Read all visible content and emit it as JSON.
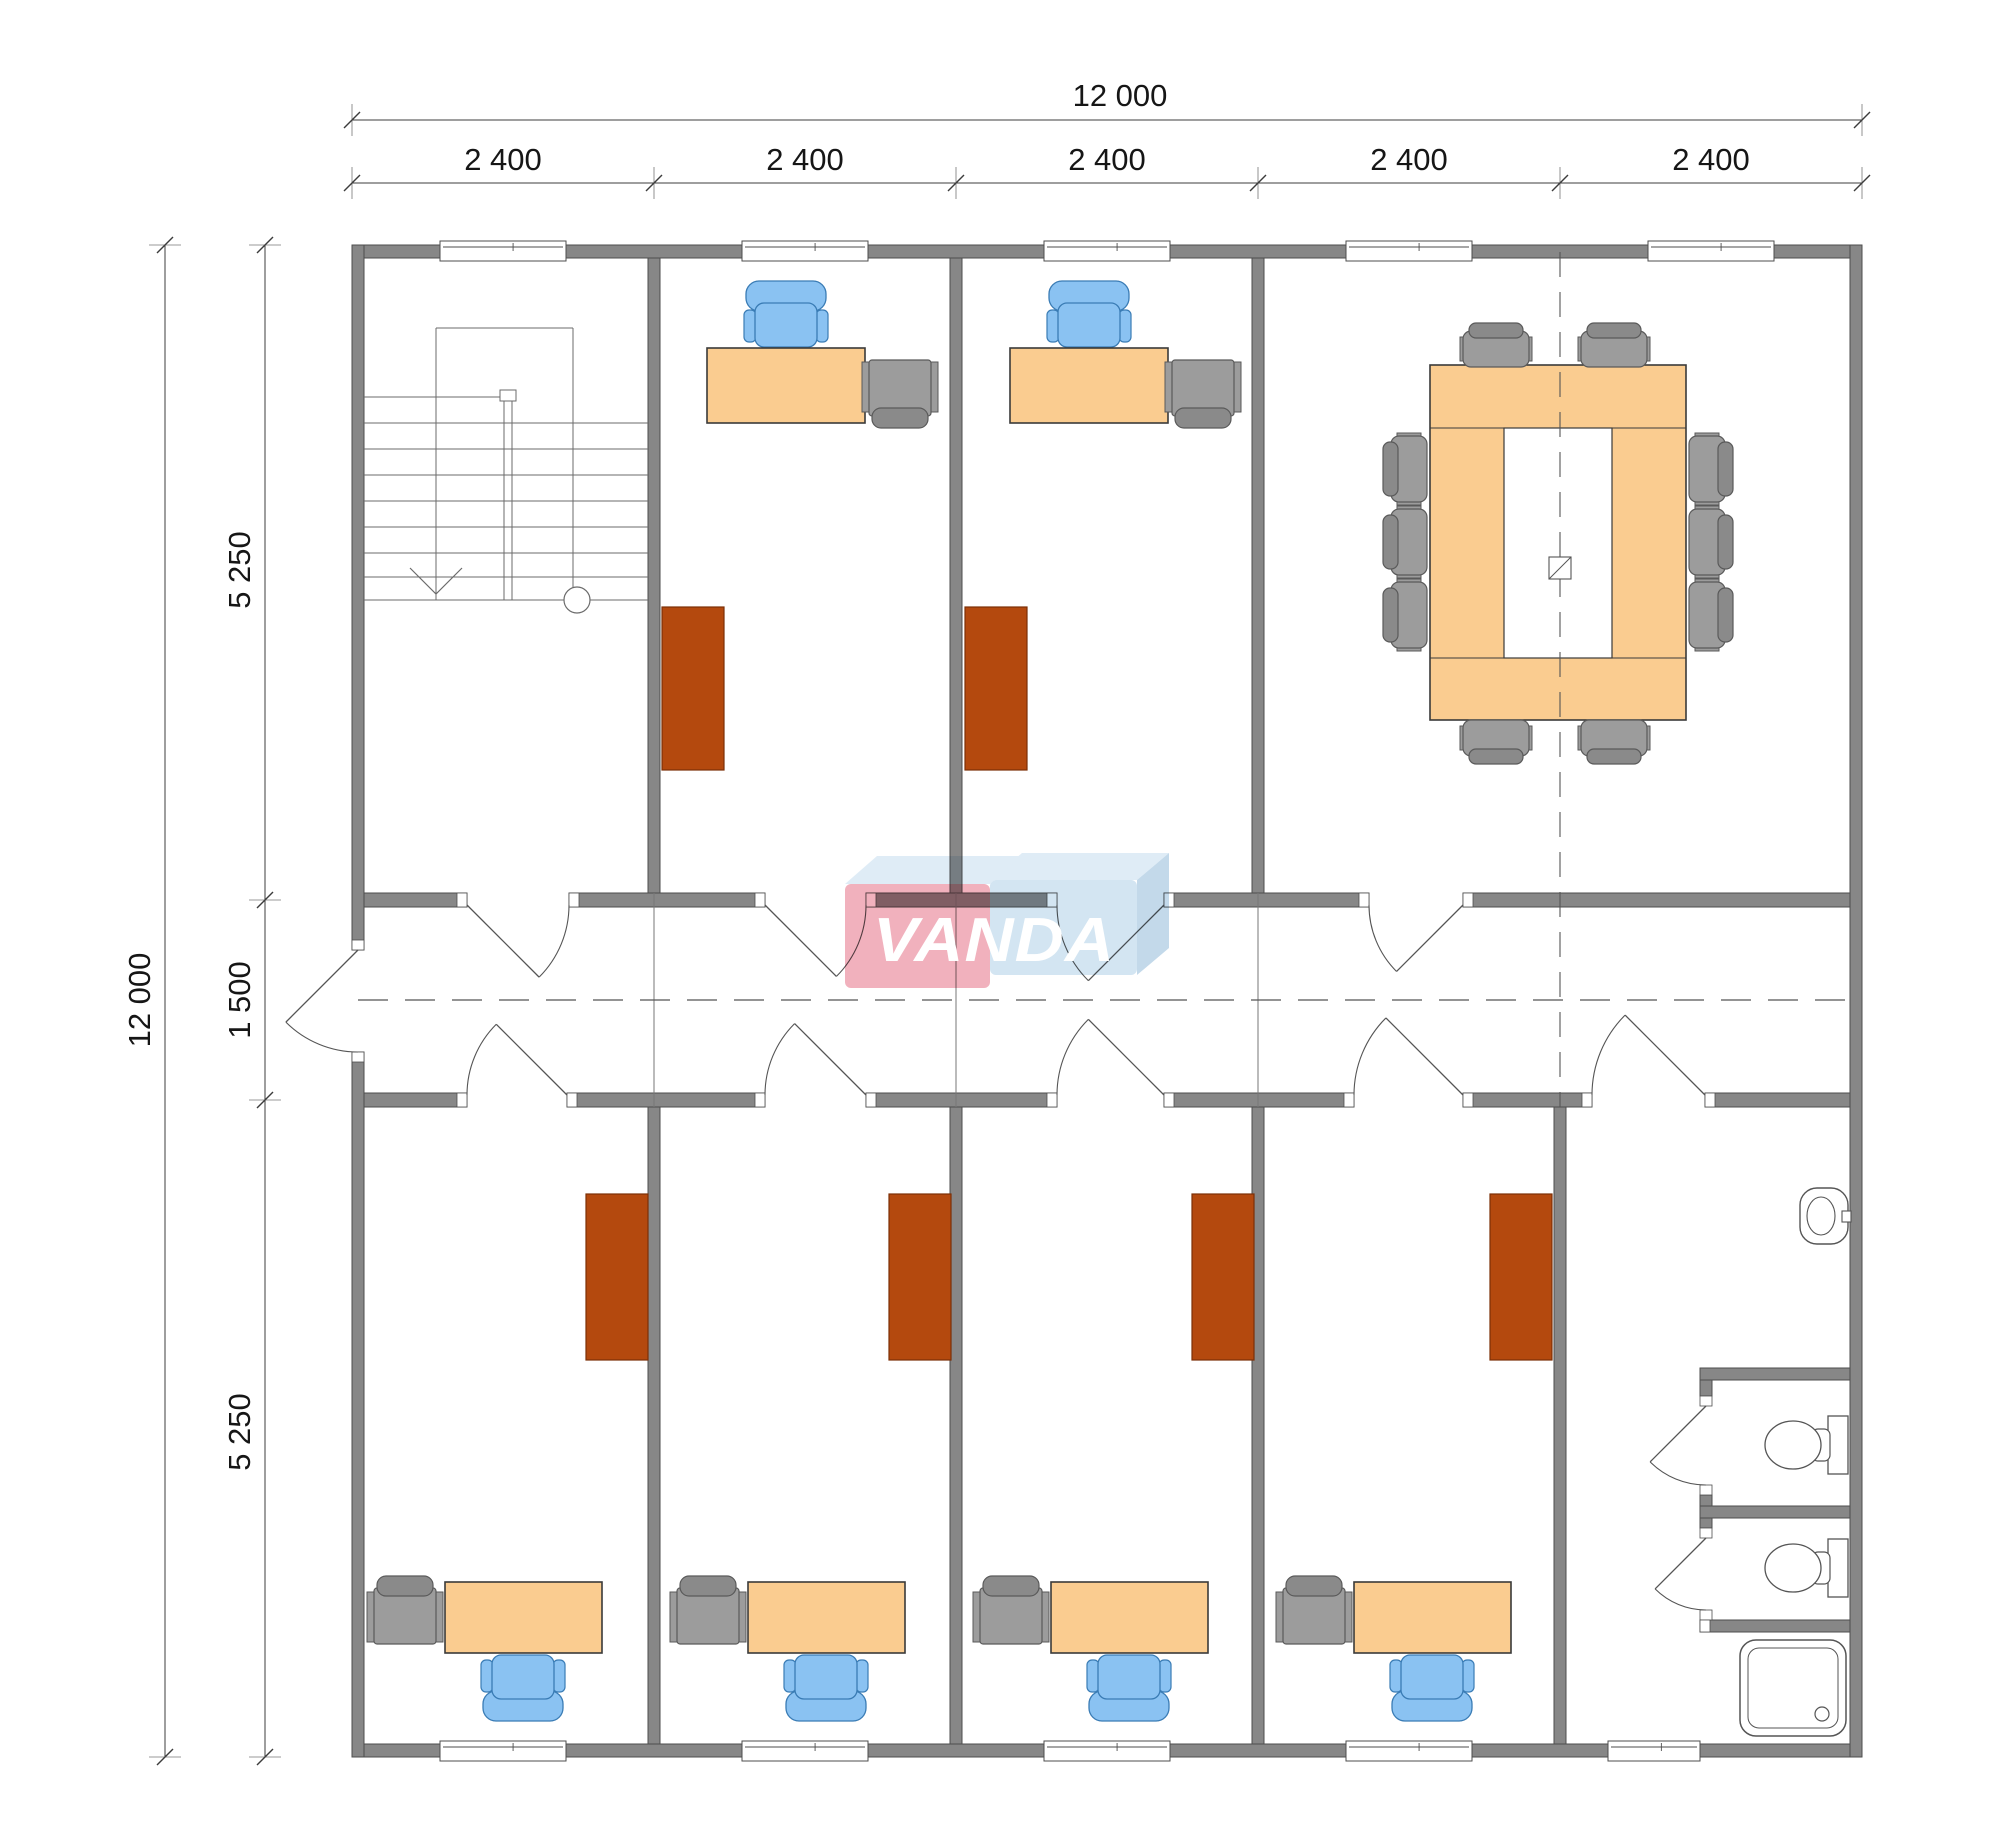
{
  "canvas": {
    "w": 2000,
    "h": 1848,
    "bg": "#ffffff"
  },
  "palette": {
    "wall": "#878787",
    "wall_stroke": "#4e4e4e",
    "cap": "#ffffff",
    "line": "#555555",
    "thin": "#777777",
    "dim": "#3c3c3c",
    "desk": "#FACC90",
    "desk_stroke": "#3a3a3a",
    "blue": "#8AC2F2",
    "blue_stroke": "#3a7cb5",
    "gray_f": "#9C9C9C",
    "gray_dark": "#8A8A8A",
    "gray_stroke": "#5a5a5a",
    "brown": "#B4490E",
    "brown_stroke": "#7c2f06",
    "logo_pink": "#F0A9B6",
    "logo_blue": "#CEE2F1",
    "logo_top": "#DCEAF5",
    "logo_side": "#BDD5E8"
  },
  "watermark": {
    "text": "VANDA"
  },
  "dimensions": {
    "top_total": {
      "label": "12 000",
      "y": 120,
      "x1": 352,
      "x2": 1862,
      "lx": 1120,
      "ly": 106
    },
    "top_bays": {
      "y": 183,
      "ticks": [
        352,
        654,
        956,
        1258,
        1560,
        1862
      ],
      "label_y": 170,
      "labels": [
        {
          "text": "2 400",
          "x": 503
        },
        {
          "text": "2 400",
          "x": 805
        },
        {
          "text": "2 400",
          "x": 1107
        },
        {
          "text": "2 400",
          "x": 1409
        },
        {
          "text": "2 400",
          "x": 1711
        }
      ]
    },
    "left_total": {
      "label": "12 000",
      "x": 165,
      "y1": 245,
      "y2": 1757,
      "lx": 150,
      "ly": 1000
    },
    "left_segs": {
      "x": 265,
      "ticks": [
        245,
        900,
        1100,
        1757
      ],
      "label_x": 250,
      "labels": [
        {
          "text": "5 250",
          "y": 570
        },
        {
          "text": "1 500",
          "y": 1000
        },
        {
          "text": "5 250",
          "y": 1432
        }
      ]
    }
  },
  "plan": {
    "outer_walls": [
      [
        352,
        245,
        1510,
        13
      ],
      [
        352,
        1744,
        1510,
        13
      ],
      [
        352,
        245,
        12,
        705
      ],
      [
        352,
        1052,
        12,
        705
      ],
      [
        1850,
        245,
        12,
        1512
      ]
    ],
    "inner_walls": [
      [
        648,
        258,
        12,
        635
      ],
      [
        950,
        258,
        12,
        635
      ],
      [
        1252,
        258,
        12,
        635
      ],
      [
        648,
        1107,
        12,
        637
      ],
      [
        950,
        1107,
        12,
        637
      ],
      [
        1252,
        1107,
        12,
        637
      ],
      [
        1554,
        1107,
        12,
        637
      ]
    ],
    "hwall_top": {
      "y": 893,
      "h": 14,
      "segs": [
        [
          364,
          467
        ],
        [
          569,
          765
        ],
        [
          866,
          1057
        ],
        [
          1164,
          1369
        ],
        [
          1463,
          1850
        ]
      ]
    },
    "hwall_bot": {
      "y": 1093,
      "h": 14,
      "segs": [
        [
          364,
          467
        ],
        [
          567,
          765
        ],
        [
          866,
          1057
        ],
        [
          1164,
          1354
        ],
        [
          1463,
          1592
        ],
        [
          1705,
          1850
        ]
      ]
    },
    "gaps_top": [
      [
        467,
        569
      ],
      [
        765,
        866
      ],
      [
        1057,
        1164
      ],
      [
        1369,
        1463
      ]
    ],
    "gaps_bot": [
      [
        467,
        567
      ],
      [
        765,
        866
      ],
      [
        1057,
        1164
      ],
      [
        1354,
        1463
      ],
      [
        1592,
        1705
      ]
    ],
    "entrance_caps": [
      [
        352,
        940,
        12,
        10
      ],
      [
        352,
        1052,
        12,
        10
      ]
    ],
    "windows_top": {
      "y": 241,
      "h": 20,
      "items": [
        [
          440,
          126
        ],
        [
          742,
          126
        ],
        [
          1044,
          126
        ],
        [
          1346,
          126
        ],
        [
          1648,
          126
        ]
      ]
    },
    "windows_bot": {
      "y": 1741,
      "h": 20,
      "items": [
        [
          440,
          126
        ],
        [
          742,
          126
        ],
        [
          1044,
          126
        ],
        [
          1346,
          126
        ],
        [
          1608,
          92
        ]
      ]
    },
    "centerlines": {
      "solid_x": [
        654,
        956,
        1258
      ],
      "cl_y1": 893,
      "cl_y2": 1107,
      "dash_x": 1560,
      "dash_y1": 252,
      "dash_y2": 1107,
      "corridor_y": 1000,
      "corridor_x1": 358,
      "corridor_x2": 1850
    },
    "doors": [
      {
        "h": [
          467,
          905
        ],
        "j": [
          569,
          905
        ],
        "r": 1
      },
      {
        "h": [
          765,
          905
        ],
        "j": [
          866,
          905
        ],
        "r": 1
      },
      {
        "h": [
          1164,
          905
        ],
        "j": [
          1057,
          905
        ],
        "r": -1
      },
      {
        "h": [
          1463,
          905
        ],
        "j": [
          1369,
          905
        ],
        "r": -1
      },
      {
        "h": [
          567,
          1095
        ],
        "j": [
          467,
          1095
        ],
        "r": 1
      },
      {
        "h": [
          866,
          1095
        ],
        "j": [
          765,
          1095
        ],
        "r": 1
      },
      {
        "h": [
          1164,
          1095
        ],
        "j": [
          1057,
          1095
        ],
        "r": 1
      },
      {
        "h": [
          1463,
          1095
        ],
        "j": [
          1354,
          1095
        ],
        "r": 1
      },
      {
        "h": [
          1705,
          1095
        ],
        "j": [
          1592,
          1095
        ],
        "r": 1
      },
      {
        "h": [
          358,
          950
        ],
        "j": [
          358,
          1052
        ],
        "r": 1
      }
    ],
    "stairs": {
      "x1": 364,
      "x2": 648,
      "outline": {
        "vx1": 436,
        "vx2": 573,
        "top": 328,
        "bot": 600
      },
      "treads_full": [
        423,
        449,
        475,
        501,
        527,
        553,
        577
      ],
      "tread_partial": 397,
      "bottom": 600,
      "rail_x": [
        504,
        512
      ],
      "rail_y1": 398,
      "rail_y2": 600,
      "rail_cap": [
        500,
        390,
        16,
        11
      ],
      "arrow": [
        [
          410,
          568
        ],
        [
          436,
          594
        ],
        [
          462,
          568
        ]
      ],
      "circle": [
        577,
        600,
        13
      ]
    },
    "offices_top": [
      {
        "desk": [
          707,
          348,
          158,
          75
        ],
        "chair_cx": 786,
        "chair_cy": 318,
        "side": [
          900,
          388
        ],
        "cab": [
          662,
          607,
          62,
          163
        ]
      },
      {
        "desk": [
          1010,
          348,
          158,
          75
        ],
        "chair_cx": 1089,
        "chair_cy": 318,
        "side": [
          1203,
          388
        ],
        "cab": [
          965,
          607,
          62,
          163
        ]
      }
    ],
    "offices_bot": [
      {
        "desk": [
          445,
          1582,
          157,
          71
        ],
        "chair_cx": 523,
        "chair_cy": 1684,
        "side": [
          405,
          1616
        ],
        "cab": [
          586,
          1194,
          62,
          166
        ]
      },
      {
        "desk": [
          748,
          1582,
          157,
          71
        ],
        "chair_cx": 826,
        "chair_cy": 1684,
        "side": [
          708,
          1616
        ],
        "cab": [
          889,
          1194,
          62,
          166
        ]
      },
      {
        "desk": [
          1051,
          1582,
          157,
          71
        ],
        "chair_cx": 1129,
        "chair_cy": 1684,
        "side": [
          1011,
          1616
        ],
        "cab": [
          1192,
          1194,
          62,
          166
        ]
      },
      {
        "desk": [
          1354,
          1582,
          157,
          71
        ],
        "chair_cx": 1432,
        "chair_cy": 1684,
        "side": [
          1314,
          1616
        ],
        "cab": [
          1490,
          1194,
          62,
          166
        ]
      }
    ],
    "meeting": {
      "table": [
        1430,
        365,
        256,
        355
      ],
      "inner": [
        1504,
        428,
        108,
        230
      ],
      "square": [
        1549,
        557,
        22
      ],
      "chairs": [
        {
          "x": 1496,
          "y": 348,
          "d": 0
        },
        {
          "x": 1614,
          "y": 348,
          "d": 0
        },
        {
          "x": 1496,
          "y": 739,
          "d": 180
        },
        {
          "x": 1614,
          "y": 739,
          "d": 180
        },
        {
          "x": 1408,
          "y": 469,
          "d": -90
        },
        {
          "x": 1408,
          "y": 542,
          "d": -90
        },
        {
          "x": 1408,
          "y": 615,
          "d": -90
        },
        {
          "x": 1708,
          "y": 469,
          "d": 90
        },
        {
          "x": 1708,
          "y": 542,
          "d": 90
        },
        {
          "x": 1708,
          "y": 615,
          "d": 90
        }
      ]
    },
    "bathroom": {
      "partitions": [
        [
          1700,
          1368,
          150,
          12
        ],
        [
          1700,
          1506,
          150,
          12
        ]
      ],
      "shower_wall": [
        1700,
        1620,
        150,
        12
      ],
      "stubs": [
        [
          1700,
          1380,
          12,
          16
        ],
        [
          1700,
          1495,
          12,
          11
        ],
        [
          1700,
          1518,
          12,
          10
        ]
      ],
      "caps": [
        [
          1700,
          1396,
          12,
          10
        ],
        [
          1700,
          1485,
          12,
          10
        ],
        [
          1700,
          1528,
          12,
          10
        ],
        [
          1700,
          1610,
          12,
          10
        ],
        [
          1700,
          1620,
          10,
          12
        ]
      ],
      "stall_doors": [
        {
          "h": [
            1706,
            1406
          ],
          "j": [
            1706,
            1485
          ],
          "r": 1
        },
        {
          "h": [
            1706,
            1538
          ],
          "j": [
            1706,
            1610
          ],
          "r": 1
        }
      ],
      "sink": {
        "x": 1800,
        "y": 1188,
        "w": 48,
        "h": 56
      },
      "toilets": [
        {
          "cy": 1445
        },
        {
          "cy": 1568
        }
      ],
      "shower_tray": [
        1740,
        1640,
        106,
        96
      ],
      "drain": [
        1822,
        1714,
        7
      ]
    },
    "logo": {
      "pink": [
        845,
        884,
        145,
        104
      ],
      "pink_top": [
        [
          845,
          884
        ],
        [
          877,
          856
        ],
        [
          1022,
          856
        ],
        [
          990,
          884
        ]
      ],
      "blue": [
        990,
        880,
        147,
        95
      ],
      "blue_top": [
        [
          990,
          880
        ],
        [
          1022,
          853
        ],
        [
          1169,
          853
        ],
        [
          1137,
          880
        ]
      ],
      "blue_side": [
        [
          1137,
          880
        ],
        [
          1169,
          853
        ],
        [
          1169,
          948
        ],
        [
          1137,
          975
        ]
      ],
      "text_x": 994,
      "text_y": 961,
      "text_len": 242
    }
  }
}
